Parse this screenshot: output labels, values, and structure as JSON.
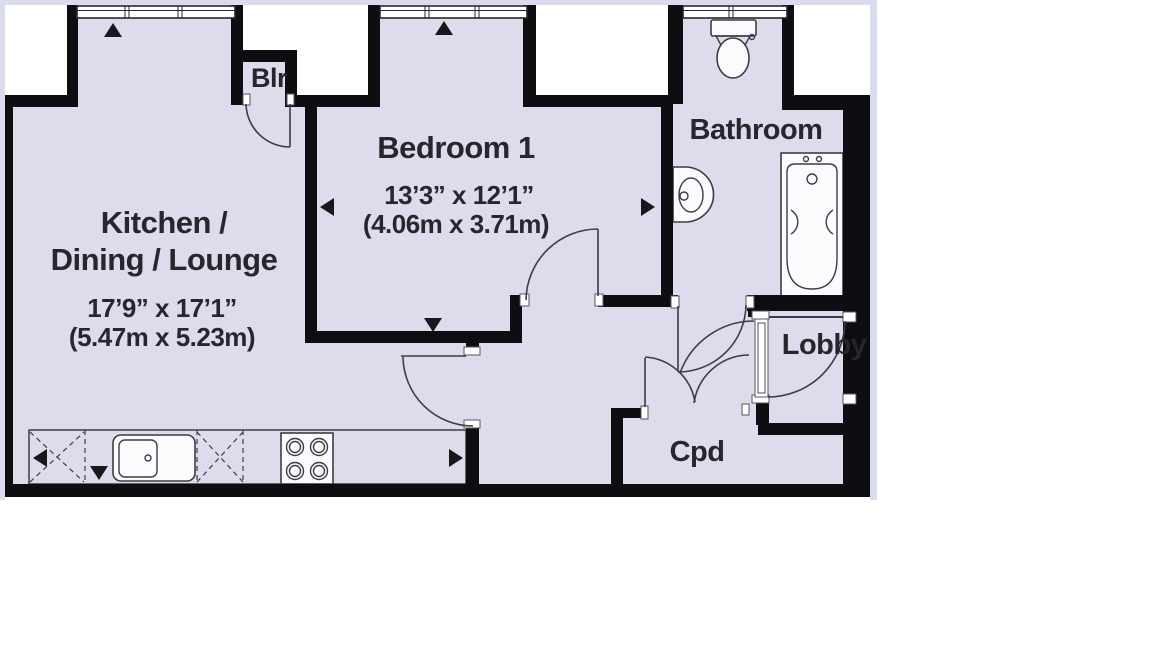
{
  "plan_type": "floor-plan",
  "rooms": {
    "kitchen": {
      "line1": "Kitchen /",
      "line2": "Dining / Lounge",
      "dims_ft": "17’9” x 17’1”",
      "dims_m": "(5.47m x 5.23m)"
    },
    "bedroom": {
      "name": "Bedroom 1",
      "dims_ft": "13’3” x 12’1”",
      "dims_m": "(4.06m x 3.71m)"
    },
    "bathroom": {
      "name": "Bathroom"
    },
    "lobby": {
      "name": "Lobby"
    },
    "cupboard": {
      "name": "Cpd"
    },
    "boiler": {
      "name": "Blr"
    }
  },
  "icons": [
    "toilet-icon",
    "bathtub-icon",
    "basin-icon",
    "kitchen-sink-icon",
    "hob-icon",
    "window-icon",
    "door-swing-arc",
    "dimension-arrow"
  ],
  "colors": {
    "floor": "#dedbec",
    "wall": "#0d0d12",
    "line": "#3c3c45",
    "ink": "#26262c",
    "frame": "#d9dcef",
    "paper": "#ffffff"
  }
}
